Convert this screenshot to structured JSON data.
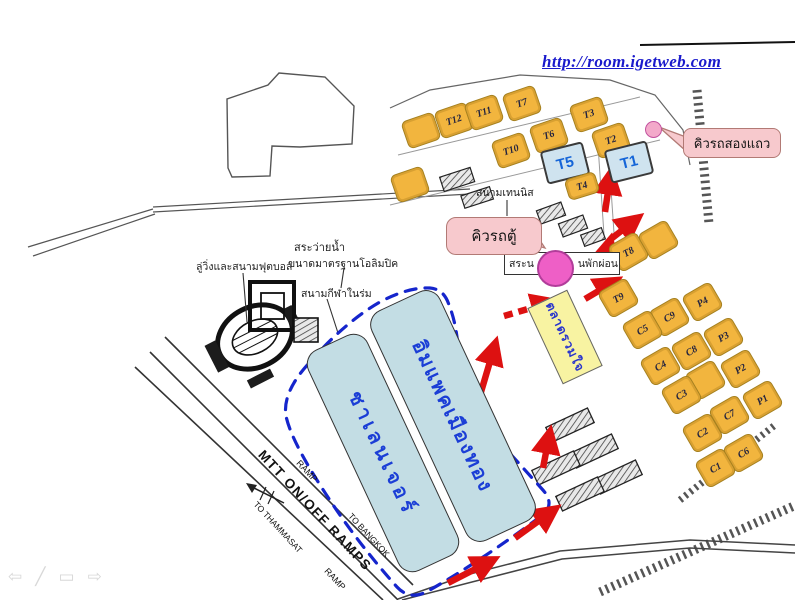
{
  "header": {
    "website_url": "http://room.igetweb.com"
  },
  "callouts": {
    "songthaew_queue": "คิวรถสองแถว",
    "van_queue": "คิวรถตู้"
  },
  "map_labels": {
    "tennis_court": "สนามเทนนิส",
    "running_track_football": "ลู่วิ่งและสนามฟุตบอล",
    "swimming_pool": "สระว่ายน้ำ",
    "swimming_pool_size": "ขนาดมาตรฐานโอลิมปิค",
    "indoor_stadium": "สนามกีฬาในร่ม",
    "pond_label_left": "สระน",
    "pond_label_right": "นพักผ่อน",
    "market": "ตลาดรวมใจ",
    "impact_hall": "อิมแพคเมืองทอง",
    "challenger_hall": "ชาเลนเจอร์",
    "mtt_ramps": "MTT ON/OFF RAMPS",
    "ramp_upper": "RAMP",
    "ramp_lower": "RAMP",
    "to_thammasat": "TO THAMMASAT",
    "to_bangkok": "TO BANGKOK"
  },
  "blocks": {
    "top_cluster": [
      "T12",
      "T11",
      "T7",
      "T10",
      "T6",
      "T3",
      "T2"
    ],
    "t4": "T4",
    "blue_terminals": [
      "T5",
      "T1"
    ],
    "right_cluster": [
      "T8",
      "T9",
      "C9",
      "P4",
      "C5",
      "C8",
      "P3",
      "C4",
      "P2",
      "C3",
      "C7",
      "P1",
      "C2",
      "C6",
      "C1"
    ]
  },
  "footer_icons": {
    "prev": "⇦",
    "pen": "╱",
    "menu": "▭",
    "next": "⇨"
  },
  "colors": {
    "orange_block": "#f2b53e",
    "blue_block": "#cfe3ef",
    "blue_block_text": "#1565d8",
    "hall_fill": "#c3dde4",
    "hall_text": "#1b3ed6",
    "market_fill": "#f8f3a2",
    "market_text": "#2a35cc",
    "route_arrow": "#dd1111",
    "loop_dash": "#1525cc",
    "url_text": "#1a1acc",
    "callout_fill": "#f7c9cd",
    "circle_small": "#f3a9ca",
    "circle_large": "#ee5fc6"
  }
}
